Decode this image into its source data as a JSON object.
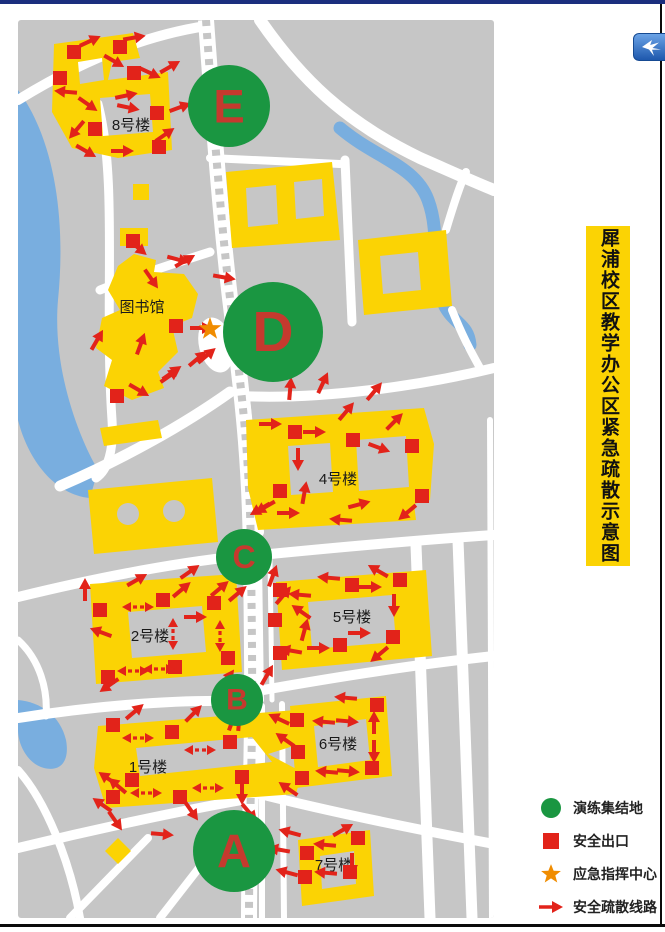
{
  "title": {
    "text": "犀浦校区教学办公区紧急疏散示意图"
  },
  "legend": {
    "items": [
      {
        "symbol": "assembly-circle",
        "label": "演练集结地"
      },
      {
        "symbol": "exit-square",
        "label": "安全出口"
      },
      {
        "symbol": "command-star",
        "label": "应急指挥中心"
      },
      {
        "symbol": "route-arrow",
        "label": "安全疏散线路"
      }
    ]
  },
  "app_icon": {
    "name": "hummingbird-app-icon"
  },
  "map": {
    "colors": {
      "ground": "#c6c6c6",
      "road": "#ffffff",
      "water": "#79aedf",
      "building": "#fbd304",
      "exit": "#e2231a",
      "arrow": "#e2231a",
      "assembly": "#1a9641",
      "letter": "#c53a2e",
      "star": "#f08c00",
      "label": "#1a1a1a",
      "title_bg": "#fbd304",
      "title_text": "#111111",
      "frame_top": "#1b2e7e",
      "frame": "#0b0b0b"
    },
    "assembly_points": [
      {
        "letter": "E",
        "x": 229,
        "y": 106,
        "r": 41
      },
      {
        "letter": "D",
        "x": 273,
        "y": 332,
        "r": 50
      },
      {
        "letter": "C",
        "x": 244,
        "y": 557,
        "r": 28
      },
      {
        "letter": "B",
        "x": 237,
        "y": 700,
        "r": 26
      },
      {
        "letter": "A",
        "x": 234,
        "y": 851,
        "r": 41
      }
    ],
    "building_labels": [
      {
        "text": "8号楼",
        "x": 131,
        "y": 130
      },
      {
        "text": "图书馆",
        "x": 142,
        "y": 312
      },
      {
        "text": "4号楼",
        "x": 338,
        "y": 484
      },
      {
        "text": "2号楼",
        "x": 150,
        "y": 641
      },
      {
        "text": "5号楼",
        "x": 352,
        "y": 622
      },
      {
        "text": "1号楼",
        "x": 148,
        "y": 772
      },
      {
        "text": "6号楼",
        "x": 338,
        "y": 749
      },
      {
        "text": "7号楼",
        "x": 334,
        "y": 870
      }
    ],
    "command_center": {
      "x": 210,
      "y": 329
    },
    "exits": [
      [
        74,
        52
      ],
      [
        120,
        47
      ],
      [
        134,
        73
      ],
      [
        60,
        78
      ],
      [
        157,
        113
      ],
      [
        95,
        129
      ],
      [
        159,
        147
      ],
      [
        133,
        241
      ],
      [
        176,
        326
      ],
      [
        117,
        396
      ],
      [
        295,
        432
      ],
      [
        353,
        440
      ],
      [
        412,
        446
      ],
      [
        280,
        491
      ],
      [
        422,
        496
      ],
      [
        100,
        610
      ],
      [
        163,
        600
      ],
      [
        214,
        603
      ],
      [
        228,
        658
      ],
      [
        175,
        667
      ],
      [
        108,
        677
      ],
      [
        280,
        590
      ],
      [
        352,
        585
      ],
      [
        400,
        580
      ],
      [
        275,
        620
      ],
      [
        280,
        653
      ],
      [
        340,
        645
      ],
      [
        393,
        637
      ],
      [
        297,
        720
      ],
      [
        377,
        705
      ],
      [
        298,
        752
      ],
      [
        372,
        768
      ],
      [
        302,
        778
      ],
      [
        358,
        838
      ],
      [
        307,
        853
      ],
      [
        350,
        872
      ],
      [
        305,
        877
      ],
      [
        113,
        725
      ],
      [
        172,
        732
      ],
      [
        230,
        742
      ],
      [
        242,
        777
      ],
      [
        132,
        780
      ],
      [
        113,
        797
      ],
      [
        180,
        797
      ]
    ],
    "arrows": [
      [
        88,
        42,
        -25
      ],
      [
        132,
        38,
        -10
      ],
      [
        112,
        60,
        30
      ],
      [
        148,
        72,
        25
      ],
      [
        168,
        68,
        -30
      ],
      [
        178,
        108,
        -20
      ],
      [
        68,
        92,
        185
      ],
      [
        86,
        103,
        35
      ],
      [
        124,
        96,
        -12
      ],
      [
        126,
        107,
        12
      ],
      [
        78,
        128,
        130
      ],
      [
        84,
        150,
        30
      ],
      [
        120,
        151,
        0
      ],
      [
        163,
        136,
        -35
      ],
      [
        136,
        246,
        40
      ],
      [
        176,
        259,
        15
      ],
      [
        222,
        277,
        10
      ],
      [
        150,
        277,
        55
      ],
      [
        183,
        262,
        -30
      ],
      [
        199,
        328,
        0
      ],
      [
        205,
        357,
        -40
      ],
      [
        168,
        377,
        -35
      ],
      [
        140,
        346,
        -70
      ],
      [
        137,
        389,
        30
      ],
      [
        96,
        342,
        -60
      ],
      [
        170,
        374,
        -35
      ],
      [
        196,
        360,
        -40
      ],
      [
        290,
        391,
        -85
      ],
      [
        322,
        385,
        -65
      ],
      [
        268,
        424,
        0
      ],
      [
        312,
        432,
        0
      ],
      [
        298,
        457,
        90
      ],
      [
        345,
        413,
        -50
      ],
      [
        373,
        393,
        -50
      ],
      [
        393,
        423,
        -45
      ],
      [
        377,
        447,
        20
      ],
      [
        262,
        508,
        150
      ],
      [
        286,
        513,
        0
      ],
      [
        304,
        495,
        -80
      ],
      [
        357,
        505,
        -15
      ],
      [
        343,
        520,
        185
      ],
      [
        409,
        511,
        140
      ],
      [
        267,
        506,
        150
      ],
      [
        218,
        590,
        -40
      ],
      [
        236,
        595,
        -40
      ],
      [
        272,
        578,
        -70
      ],
      [
        282,
        597,
        -50
      ],
      [
        135,
        581,
        -30
      ],
      [
        188,
        573,
        -35
      ],
      [
        180,
        591,
        -40
      ],
      [
        138,
        607,
        0,
        "d"
      ],
      [
        103,
        633,
        200
      ],
      [
        173,
        634,
        90,
        "d"
      ],
      [
        220,
        636,
        90,
        "d"
      ],
      [
        193,
        617,
        0
      ],
      [
        133,
        671,
        0,
        "d"
      ],
      [
        159,
        669,
        0,
        "d"
      ],
      [
        111,
        684,
        145
      ],
      [
        85,
        592,
        -90
      ],
      [
        226,
        681,
        -55
      ],
      [
        266,
        677,
        -60
      ],
      [
        239,
        722,
        -85
      ],
      [
        331,
        578,
        185
      ],
      [
        368,
        587,
        0
      ],
      [
        302,
        595,
        185
      ],
      [
        303,
        613,
        215
      ],
      [
        304,
        632,
        -75
      ],
      [
        293,
        651,
        190
      ],
      [
        316,
        648,
        0
      ],
      [
        357,
        633,
        0
      ],
      [
        394,
        603,
        90
      ],
      [
        381,
        653,
        140
      ],
      [
        380,
        572,
        -150
      ],
      [
        326,
        722,
        185
      ],
      [
        345,
        721,
        5
      ],
      [
        348,
        698,
        185
      ],
      [
        374,
        725,
        -90
      ],
      [
        374,
        749,
        90
      ],
      [
        329,
        772,
        185
      ],
      [
        346,
        771,
        5
      ],
      [
        281,
        720,
        205
      ],
      [
        287,
        741,
        215
      ],
      [
        290,
        790,
        215
      ],
      [
        292,
        833,
        195
      ],
      [
        341,
        831,
        -30
      ],
      [
        327,
        845,
        185
      ],
      [
        281,
        850,
        190
      ],
      [
        289,
        873,
        195
      ],
      [
        328,
        873,
        185
      ],
      [
        352,
        862,
        90
      ],
      [
        133,
        713,
        -40
      ],
      [
        192,
        715,
        -45
      ],
      [
        232,
        722,
        -70
      ],
      [
        138,
        738,
        0,
        "d"
      ],
      [
        200,
        750,
        0,
        "d"
      ],
      [
        110,
        780,
        215
      ],
      [
        119,
        787,
        220
      ],
      [
        146,
        793,
        0,
        "d"
      ],
      [
        208,
        788,
        0,
        "d"
      ],
      [
        104,
        806,
        215
      ],
      [
        114,
        819,
        55
      ],
      [
        160,
        834,
        5
      ],
      [
        190,
        809,
        55
      ],
      [
        242,
        791,
        90
      ],
      [
        248,
        811,
        50
      ]
    ]
  }
}
